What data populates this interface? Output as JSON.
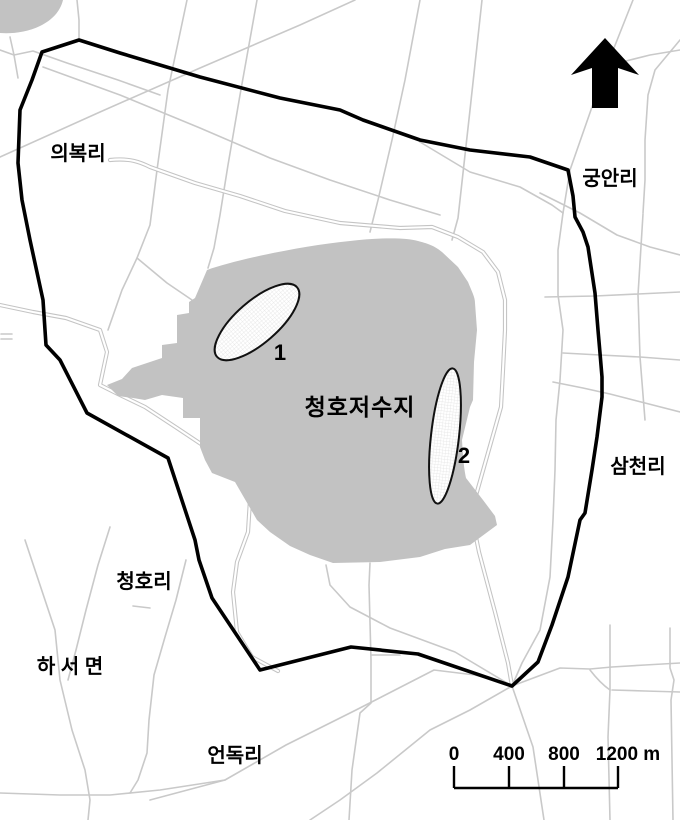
{
  "map": {
    "labels": {
      "uibok": "의복리",
      "gungan": "궁안리",
      "samcheon": "삼천리",
      "cheongho_ri": "청호리",
      "haseo": "하 서 면",
      "eondok": "언독리",
      "reservoir": "청호저수지",
      "site1": "1",
      "site2": "2"
    },
    "scale_bar": {
      "t0": "0",
      "t400": "400",
      "t800": "800",
      "t1200": "1200 m"
    },
    "icons": {
      "north_arrow": "north-arrow"
    },
    "colors": {
      "boundary": "#000000",
      "water_fill": "#c2c2c2",
      "road": "#c9c9c9",
      "site_pattern_grid": "#e2e2e2"
    }
  }
}
